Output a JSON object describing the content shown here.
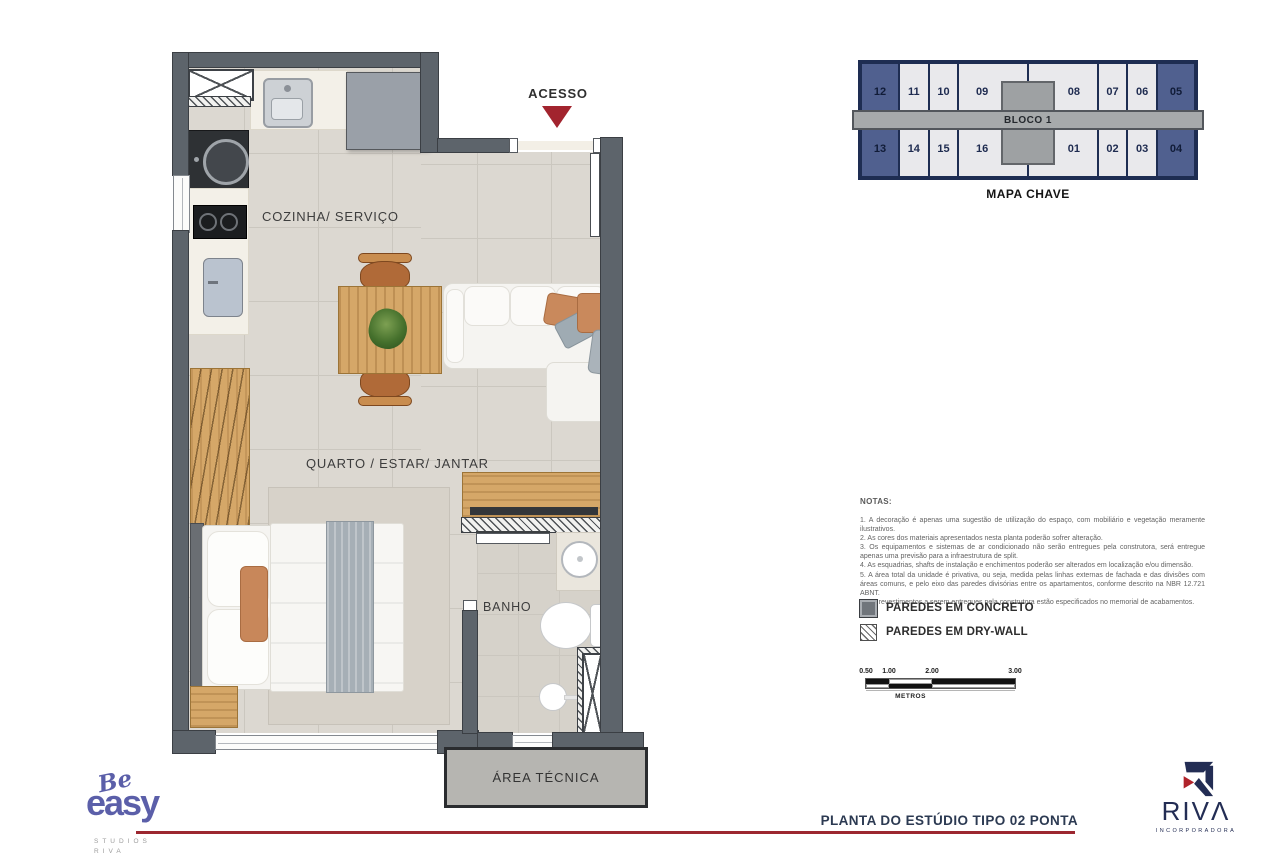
{
  "plan": {
    "room_labels": {
      "acesso": "ACESSO",
      "cozinha_servico": "COZINHA/ SERVIÇO",
      "quarto_estar_jantar": "QUARTO / ESTAR/ JANTAR",
      "banho": "BANHO",
      "area_tecnica": "ÁREA TÉCNICA"
    }
  },
  "mapa_chave": {
    "title": "MAPA CHAVE",
    "bloco_label": "BLOCO 1",
    "top_row": [
      "12",
      "11",
      "10",
      "09",
      "08",
      "07",
      "06",
      "05"
    ],
    "bottom_row": [
      "13",
      "14",
      "15",
      "16",
      "01",
      "02",
      "03",
      "04"
    ],
    "highlighted_units": [
      "12",
      "05",
      "13",
      "04"
    ],
    "colors": {
      "highlight": "#50608f",
      "cell": "#e9e9ec",
      "border": "#1e2d52",
      "corridor": "#a7aaab"
    }
  },
  "notas": {
    "title": "NOTAS:",
    "items": [
      "1. A decoração é apenas uma sugestão de utilização do espaço, com mobiliário e vegetação meramente ilustrativos.",
      "2. As cores dos materiais apresentados nesta planta poderão sofrer alteração.",
      "3. Os equipamentos e sistemas de ar condicionado não serão entregues pela construtora, será entregue apenas uma previsão para a infraestrutura de split.",
      "4. As esquadrias, shafts de instalação e enchimentos poderão ser alterados em localização e/ou dimensão.",
      "5. A área total da unidade é privativa, ou seja, medida pelas linhas externas de fachada e das divisões com áreas comuns, e pelo eixo das paredes divisórias entre os apartamentos, conforme descrito na NBR 12.721 ABNT.",
      "6. Os revestimentos a serem entregues pela construtora estão especificados no memorial de acabamentos."
    ]
  },
  "legend": {
    "concrete": "PAREDES EM CONCRETO",
    "drywall": "PAREDES EM DRY-WALL"
  },
  "scale_bar": {
    "ticks": [
      "0.50",
      "1.00",
      "2.00",
      "3.00"
    ],
    "unit": "METROS"
  },
  "footer": {
    "plan_title": "PLANTA DO ESTÚDIO TIPO 02 PONTA",
    "brand": {
      "script": "Be",
      "word": "easy",
      "sub_line1": "STUDIOS",
      "sub_line2": "RIVA"
    },
    "developer": {
      "wordmark": "RIVΛ",
      "subtitle": "INCORPORADORA"
    }
  },
  "accent_colors": {
    "red": "#9c2730",
    "navy": "#2c3a52",
    "purple": "#5b5fa9"
  }
}
